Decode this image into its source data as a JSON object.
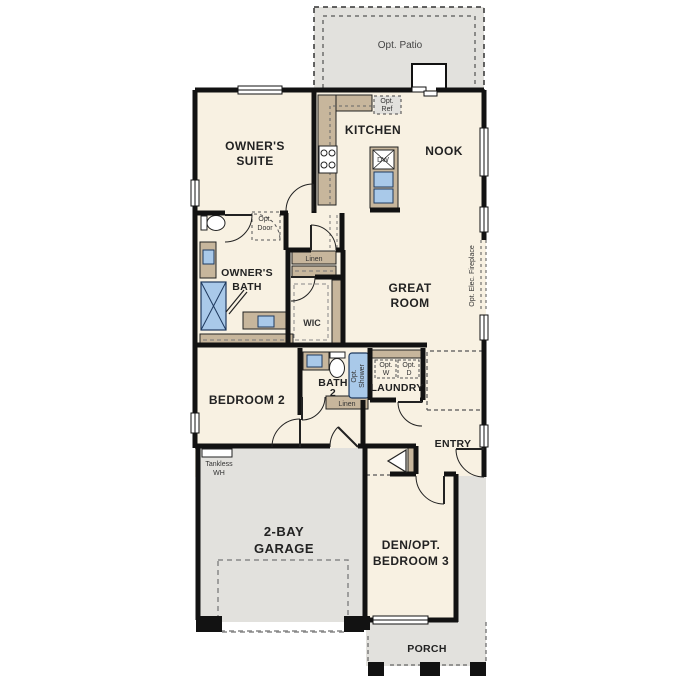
{
  "plan": {
    "type": "single-story residential floor plan",
    "labels": {
      "opt_patio": "Opt. Patio",
      "opt_ref": [
        "Opt.",
        "Ref"
      ],
      "kitchen": "KITCHEN",
      "nook": "NOOK",
      "owners_suite": [
        "OWNER'S",
        "SUITE"
      ],
      "dw": "DW",
      "opt_door": [
        "Opt.",
        "Door"
      ],
      "linen_upper": "Linen",
      "owners_bath": [
        "OWNER'S",
        "BATH"
      ],
      "wic": "WIC",
      "great_room": [
        "GREAT",
        "ROOM"
      ],
      "opt_elec_fireplace": "Opt. Elec. Fireplace",
      "bedroom2": "BEDROOM 2",
      "bath2": [
        "BATH",
        "2"
      ],
      "opt_shower": [
        "Opt.",
        "Shower"
      ],
      "opt_washer": [
        "Opt.",
        "W"
      ],
      "opt_dryer": [
        "Opt.",
        "D"
      ],
      "laundry": "LAUNDRY",
      "linen_lower": "Linen",
      "entry": "ENTRY",
      "tankless_wh": [
        "Tankless",
        "WH"
      ],
      "garage": [
        "2-BAY",
        "GARAGE"
      ],
      "den": [
        "DEN/OPT.",
        "BEDROOM 3"
      ],
      "porch": "PORCH"
    },
    "colors": {
      "exterior_concrete": "#e2e1dd",
      "interior_floor": "#f8f1e2",
      "cabinet_tan": "#c7b69c",
      "fixture_blue": "#a9c9e9",
      "fixture_blue_stroke": "#1f3a5f",
      "wall": "#121212",
      "dash_gray": "#777777"
    }
  }
}
